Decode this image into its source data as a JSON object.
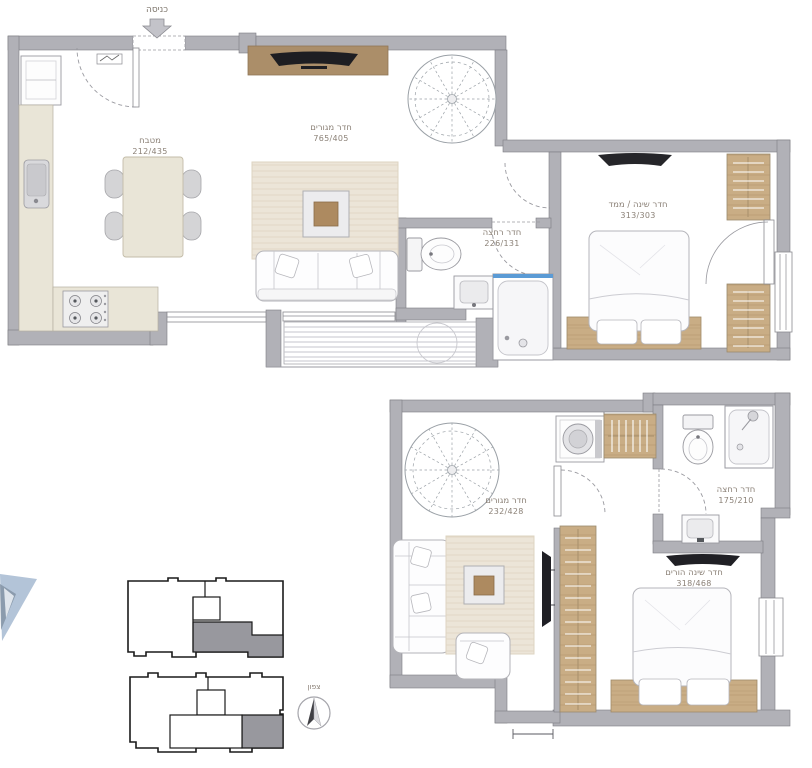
{
  "plan": {
    "entrance_label": "כניסה",
    "north_label": "צפון"
  },
  "upper_floor": {
    "kitchen": {
      "name": "מטבח",
      "dims": "212/435"
    },
    "living_room": {
      "name": "חדר מגורים",
      "dims": "765/405"
    },
    "bathroom": {
      "name": "חדר רחצה",
      "dims": "226/131"
    },
    "bedroom_safe_room": {
      "name": "חדר שינה / ממד",
      "dims": "313/303"
    }
  },
  "lower_floor": {
    "family_room": {
      "name": "חדר מגורים",
      "dims": "232/428"
    },
    "bathroom": {
      "name": "חדר רחצה",
      "dims": "175/210"
    },
    "master_bedroom": {
      "name": "חדר שינה הורים",
      "dims": "318/468"
    }
  },
  "icons": {
    "entrance_arrow": "down-arrow",
    "north_compass": "compass-needle",
    "spiral_staircase": "spiral-stair",
    "furniture": [
      "bed",
      "sofa",
      "armchair",
      "dining-table",
      "fridge",
      "stove",
      "sink",
      "toilet",
      "shower",
      "washing-machine",
      "wardrobe",
      "tv",
      "coffee-table"
    ]
  },
  "colors": {
    "wall": "#b1b1b7",
    "wall_edge": "#7c7c83",
    "wood": "#c9ad85",
    "counter": "#e9e5d7",
    "rug": "#ece5d8",
    "shower_accent": "#5b9bd5",
    "keyplan_highlight": "#98989e",
    "logo_blue": "#b3c4d8",
    "label_text": "#8b8177"
  }
}
